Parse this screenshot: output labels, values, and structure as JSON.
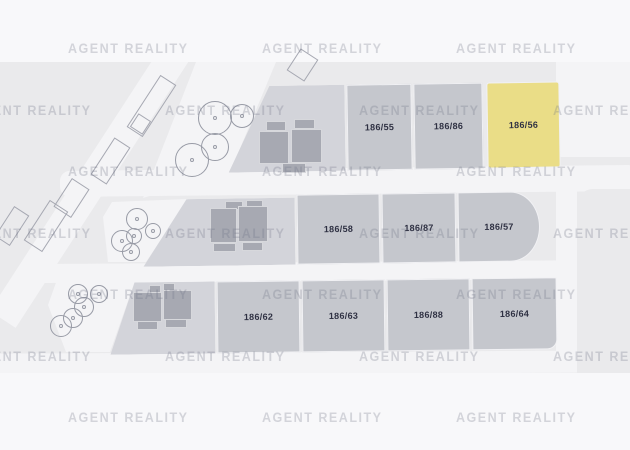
{
  "watermark": {
    "text": "AGENT REALITY"
  },
  "plots": {
    "row1": {
      "items": [
        {
          "label": "186/55",
          "highlighted": false
        },
        {
          "label": "186/86",
          "highlighted": false
        },
        {
          "label": "186/56",
          "highlighted": true
        }
      ]
    },
    "row2": {
      "items": [
        {
          "label": "186/58",
          "highlighted": false
        },
        {
          "label": "186/87",
          "highlighted": false
        },
        {
          "label": "186/57",
          "highlighted": false
        }
      ]
    },
    "row3": {
      "items": [
        {
          "label": "186/62",
          "highlighted": false
        },
        {
          "label": "186/63",
          "highlighted": false
        },
        {
          "label": "186/88",
          "highlighted": false
        },
        {
          "label": "186/64",
          "highlighted": false
        }
      ]
    }
  },
  "colors": {
    "page_bg": "#f8f8fa",
    "map_bg": "#eaeaec",
    "road": "#f4f4f6",
    "plot_gray": "#c5c7cd",
    "building_plot_gray": "#d3d4da",
    "highlight_yellow": "#eadd87",
    "building_fill": "#a7a9b2",
    "plot_label_text": "#2f3143",
    "watermark_text": "rgba(112,116,134,0.27)"
  },
  "trees": [
    {
      "x": 215,
      "y": 118,
      "r": 17
    },
    {
      "x": 242,
      "y": 116,
      "r": 12
    },
    {
      "x": 192,
      "y": 160,
      "r": 17
    },
    {
      "x": 215,
      "y": 147,
      "r": 14
    },
    {
      "x": 137,
      "y": 219,
      "r": 11
    },
    {
      "x": 153,
      "y": 231,
      "r": 8
    },
    {
      "x": 122,
      "y": 241,
      "r": 11
    },
    {
      "x": 134,
      "y": 236,
      "r": 8
    },
    {
      "x": 131,
      "y": 252,
      "r": 9
    },
    {
      "x": 78,
      "y": 294,
      "r": 10
    },
    {
      "x": 99,
      "y": 294,
      "r": 9
    },
    {
      "x": 84,
      "y": 307,
      "r": 10
    },
    {
      "x": 73,
      "y": 318,
      "r": 10
    },
    {
      "x": 61,
      "y": 326,
      "r": 11
    }
  ],
  "watermark_grid": {
    "row_ys": [
      41,
      103,
      164,
      226,
      287,
      349,
      410
    ],
    "cols_a": [
      68,
      262,
      456
    ],
    "cols_b": [
      -29,
      165,
      359,
      553
    ]
  }
}
